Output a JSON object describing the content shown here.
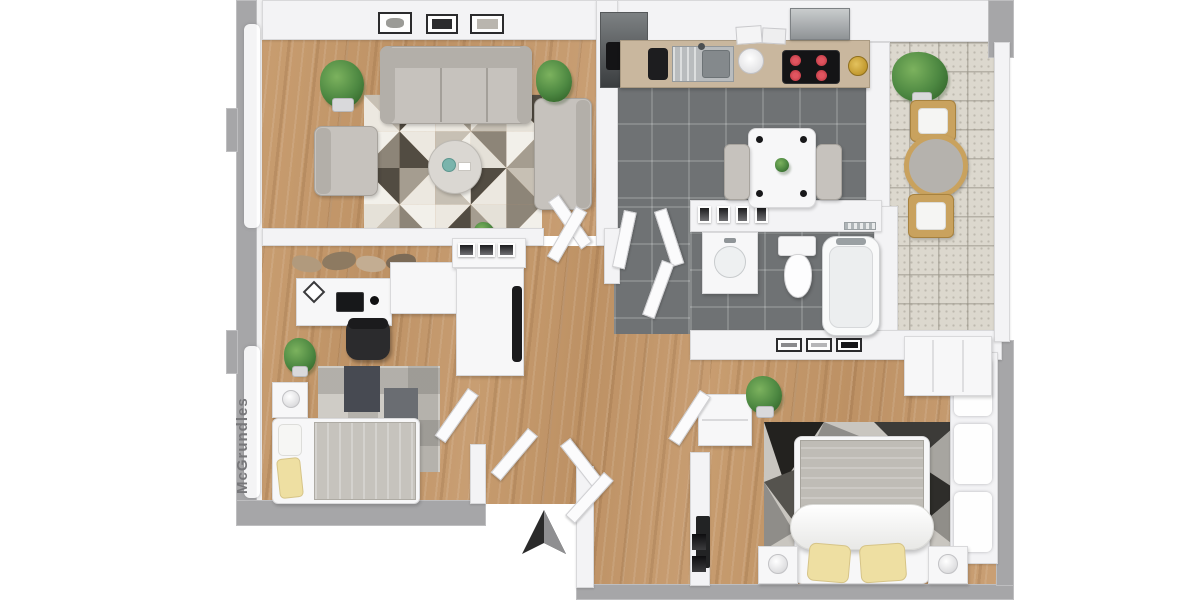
{
  "watermark": {
    "text": "McGrundles"
  },
  "compass": {
    "icon": "north-arrow"
  },
  "colors": {
    "background": "#ffffff",
    "outer_wall": "#a6a6a8",
    "inner_wall": "#f3f3f5",
    "wall_edge": "#d8d8da",
    "wood_floor": "#c49a6e",
    "dark_tile": "#6f7274",
    "balcony_tile": "#dcd8ce",
    "sofa_gray": "#c6c2bd",
    "sofa_shadow": "#b3afa9",
    "plant_green": "#4c8741",
    "wood_furniture": "#c9a25e",
    "pillow_yellow": "#eedfa2",
    "burner_red": "#b5323c",
    "vase_teal": "#7ab4ac",
    "dark_appliance": "#3a3d3f",
    "counter_top": "#c9b79e",
    "arrow_dark": "#2a2a2a",
    "watermark_gray": "#77777a"
  },
  "rooms": {
    "living_room": {
      "label": "living-room",
      "floor": "wood",
      "items": [
        "three-seat-sofa",
        "armchair",
        "chaise-sofa",
        "round-coffee-table",
        "teal-vase",
        "geometric-triangle-rug",
        "potted-plant-left",
        "potted-plant-right",
        "three-wall-frames",
        "mini-plant"
      ]
    },
    "kitchen": {
      "label": "kitchen",
      "floor": "dark-tile",
      "items": [
        "counter",
        "stainless-sink",
        "coffee-machine",
        "cooktop-4-burners",
        "range-hood",
        "tall-fridge",
        "white-bowl",
        "cutting-boards",
        "gold-fruit-bowl",
        "dining-table",
        "two-gray-chairs",
        "table-plant",
        "four-placemats"
      ]
    },
    "bathroom": {
      "label": "bathroom",
      "floor": "dark-tile",
      "items": [
        "vanity-sink",
        "toilet",
        "bathtub",
        "transom-windows",
        "three-small-frames",
        "chrome-shelf"
      ]
    },
    "study_bedroom": {
      "label": "study-bedroom",
      "floor": "wood",
      "items": [
        "corner-desk",
        "laptop",
        "desk-chair",
        "photo-frame",
        "mouse",
        "coat-rack-clothes",
        "sideboard-with-three-frames",
        "wardrobe-with-mirror",
        "single-bed",
        "white-pillow",
        "yellow-pillow",
        "checkered-rug",
        "nightstand-with-lamp",
        "potted-plant"
      ]
    },
    "master_bedroom": {
      "label": "master-bedroom",
      "floor": "wood",
      "items": [
        "double-bed",
        "gray-blanket",
        "white-duvet-roll",
        "two-yellow-pillows",
        "geometric-shard-rug",
        "nightstand-lamp-left",
        "nightstand-lamp-right",
        "dresser",
        "tv",
        "wardrobe",
        "window-curtains"
      ]
    },
    "hallway": {
      "label": "hallway",
      "floor": "wood",
      "items": [
        "open-doors",
        "potted-plant",
        "entry-vestibule",
        "intercom-panel"
      ]
    },
    "balcony": {
      "label": "balcony",
      "floor": "speckled-tile",
      "items": [
        "round-table",
        "wooden-chair-top",
        "wooden-chair-bottom",
        "potted-plant"
      ]
    }
  }
}
